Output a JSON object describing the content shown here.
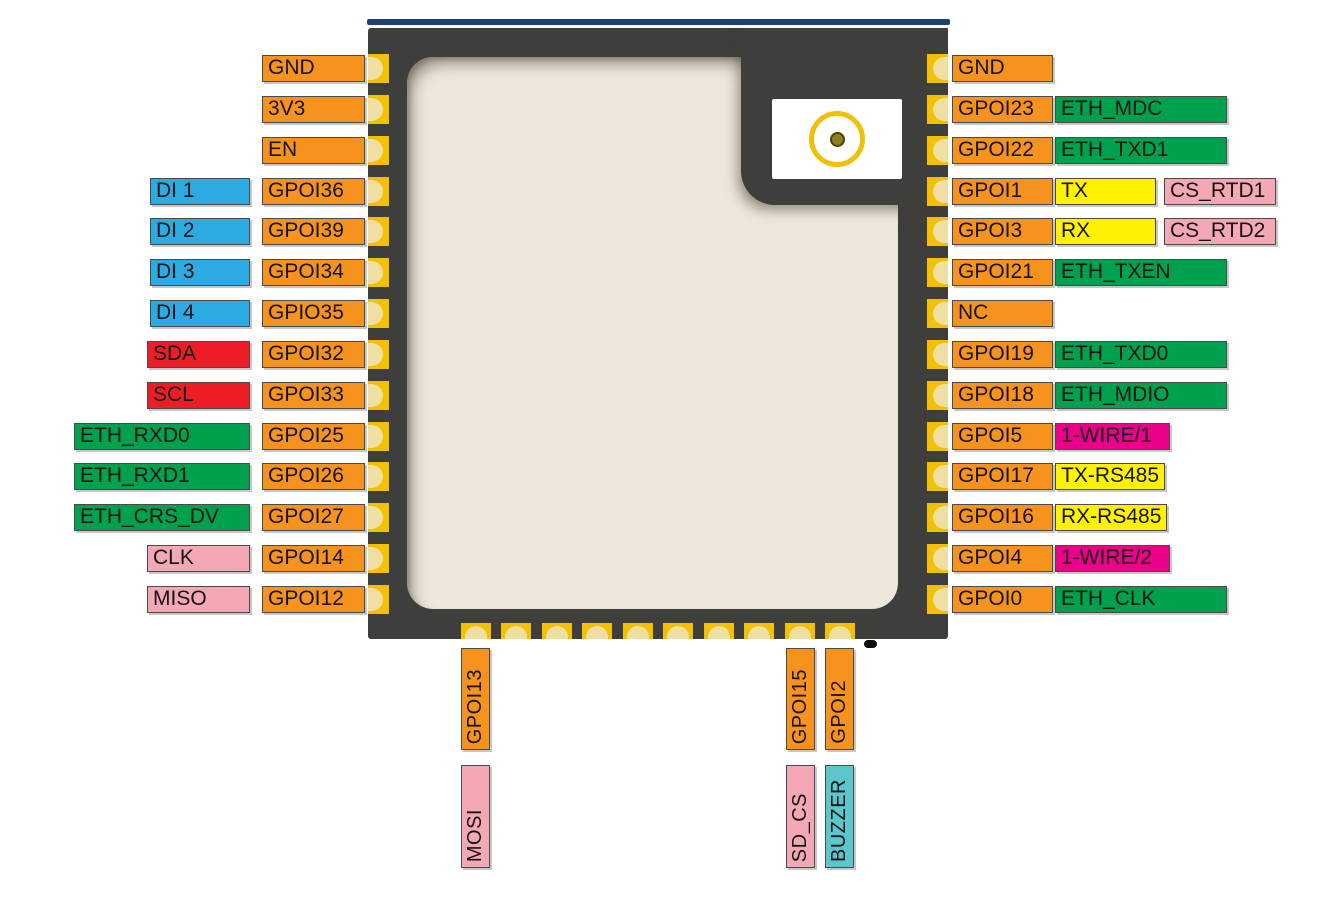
{
  "colors": {
    "orange": "#F6921E",
    "blue": "#2CABE2",
    "red": "#EE1C25",
    "green": "#00A14E",
    "pink": "#F4A8B5",
    "yellow": "#FFF200",
    "magenta": "#EB008B",
    "cyan": "#5BC6CB",
    "chip_body": "#3E3E3C",
    "chip_shield": "#EDE8DB",
    "pin_gold": "#F3C101",
    "pin_gold_light": "#EFDFA3",
    "top_edge_line": "#1E3F72",
    "antenna_ring": "#EFC007",
    "antenna_dot": "#8F7D26",
    "label_text": "#141414"
  },
  "left_rows": [
    {
      "gpio": "GND"
    },
    {
      "gpio": "3V3"
    },
    {
      "gpio": "EN"
    },
    {
      "gpio": "GPOI36",
      "fn": [
        {
          "label": "DI 1",
          "color": "blue"
        }
      ]
    },
    {
      "gpio": "GPOI39",
      "fn": [
        {
          "label": "DI 2",
          "color": "blue"
        }
      ]
    },
    {
      "gpio": "GPOI34",
      "fn": [
        {
          "label": "DI 3",
          "color": "blue"
        }
      ]
    },
    {
      "gpio": "GPIO35",
      "fn": [
        {
          "label": "DI 4",
          "color": "blue"
        }
      ]
    },
    {
      "gpio": "GPOI32",
      "fn": [
        {
          "label": "SDA",
          "color": "red"
        }
      ]
    },
    {
      "gpio": "GPOI33",
      "fn": [
        {
          "label": "SCL",
          "color": "red"
        }
      ]
    },
    {
      "gpio": "GPOI25",
      "fn": [
        {
          "label": "ETH_RXD0",
          "color": "green"
        }
      ]
    },
    {
      "gpio": "GPOI26",
      "fn": [
        {
          "label": "ETH_RXD1",
          "color": "green"
        }
      ]
    },
    {
      "gpio": "GPOI27",
      "fn": [
        {
          "label": "ETH_CRS_DV",
          "color": "green"
        }
      ]
    },
    {
      "gpio": "GPOI14",
      "fn": [
        {
          "label": "CLK",
          "color": "pink"
        }
      ]
    },
    {
      "gpio": "GPOI12",
      "fn": [
        {
          "label": "MISO",
          "color": "pink"
        }
      ]
    }
  ],
  "right_rows": [
    {
      "gpio": "GND"
    },
    {
      "gpio": "GPOI23",
      "fn": [
        {
          "label": "ETH_MDC",
          "color": "green"
        }
      ]
    },
    {
      "gpio": "GPOI22",
      "fn": [
        {
          "label": "ETH_TXD1",
          "color": "green"
        }
      ]
    },
    {
      "gpio": "GPOI1",
      "fn": [
        {
          "label": "TX",
          "color": "yellow"
        },
        {
          "label": "CS_RTD1",
          "color": "pink"
        }
      ]
    },
    {
      "gpio": "GPOI3",
      "fn": [
        {
          "label": "RX",
          "color": "yellow"
        },
        {
          "label": "CS_RTD2",
          "color": "pink"
        }
      ]
    },
    {
      "gpio": "GPOI21",
      "fn": [
        {
          "label": "ETH_TXEN",
          "color": "green"
        }
      ]
    },
    {
      "gpio": "NC"
    },
    {
      "gpio": "GPOI19",
      "fn": [
        {
          "label": "ETH_TXD0",
          "color": "green"
        }
      ]
    },
    {
      "gpio": "GPOI18",
      "fn": [
        {
          "label": "ETH_MDIO",
          "color": "green"
        }
      ]
    },
    {
      "gpio": "GPOI5",
      "fn": [
        {
          "label": "1-WIRE/1",
          "color": "magenta"
        }
      ]
    },
    {
      "gpio": "GPOI17",
      "fn": [
        {
          "label": "TX-RS485",
          "color": "yellow"
        }
      ]
    },
    {
      "gpio": "GPOI16",
      "fn": [
        {
          "label": "RX-RS485",
          "color": "yellow"
        }
      ]
    },
    {
      "gpio": "GPOI4",
      "fn": [
        {
          "label": "1-WIRE/2",
          "color": "magenta"
        }
      ]
    },
    {
      "gpio": "GPOI0",
      "fn": [
        {
          "label": "ETH_CLK",
          "color": "green"
        }
      ]
    }
  ],
  "bottom_cols": [
    {
      "gpio": "GPOI13",
      "fn": {
        "label": "MOSI",
        "color": "pink"
      }
    },
    {
      "gpio": "GPOI15",
      "fn": {
        "label": "SD_CS",
        "color": "pink"
      }
    },
    {
      "gpio": "GPOI2",
      "fn": {
        "label": "BUZZER",
        "color": "cyan"
      }
    }
  ]
}
